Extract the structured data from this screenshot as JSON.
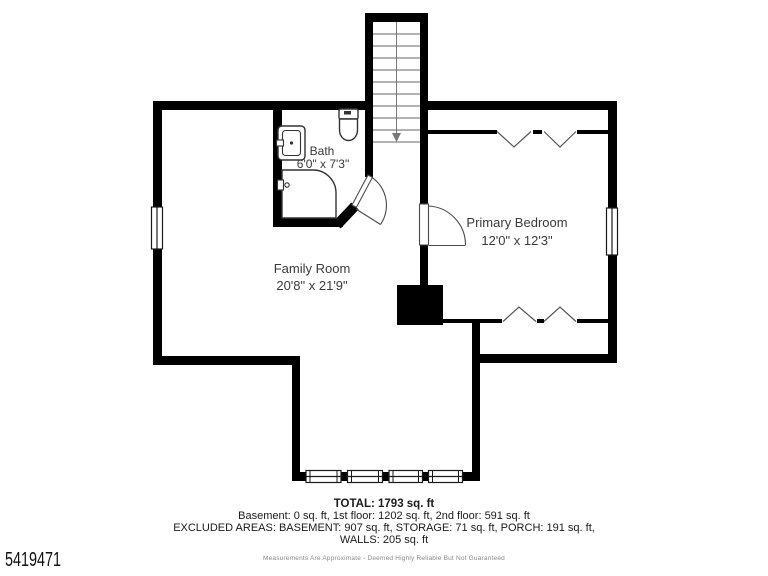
{
  "floor_plan": {
    "rooms": {
      "bath": {
        "name": "Bath",
        "dimensions": "6'0\" x 7'3\""
      },
      "family_room": {
        "name": "Family Room",
        "dimensions": "20'8\" x 21'9\""
      },
      "primary_bedroom": {
        "name": "Primary Bedroom",
        "dimensions": "12'0\" x 12'3\""
      }
    },
    "features": [
      "staircase-down",
      "bath-sink",
      "toilet",
      "shower",
      "closets",
      "windows",
      "chimney"
    ]
  },
  "summary": {
    "total": "TOTAL: 1793 sq. ft",
    "floors": "Basement: 0 sq. ft, 1st floor: 1202 sq. ft, 2nd floor: 591 sq. ft",
    "excluded": "EXCLUDED AREAS: BASEMENT: 907 sq. ft, STORAGE: 71 sq. ft, PORCH: 191 sq. ft,",
    "walls": "WALLS: 205 sq. ft",
    "disclaimer": "Measurements Are Approximate - Deemed Highly Reliable But Not Guaranteed"
  },
  "listing_id": "5419471",
  "colors": {
    "wall": "#000000",
    "background": "#ffffff",
    "label_text": "#3a3a3a",
    "fixture_stroke": "#333333",
    "door_stroke": "#4a4a4a"
  }
}
